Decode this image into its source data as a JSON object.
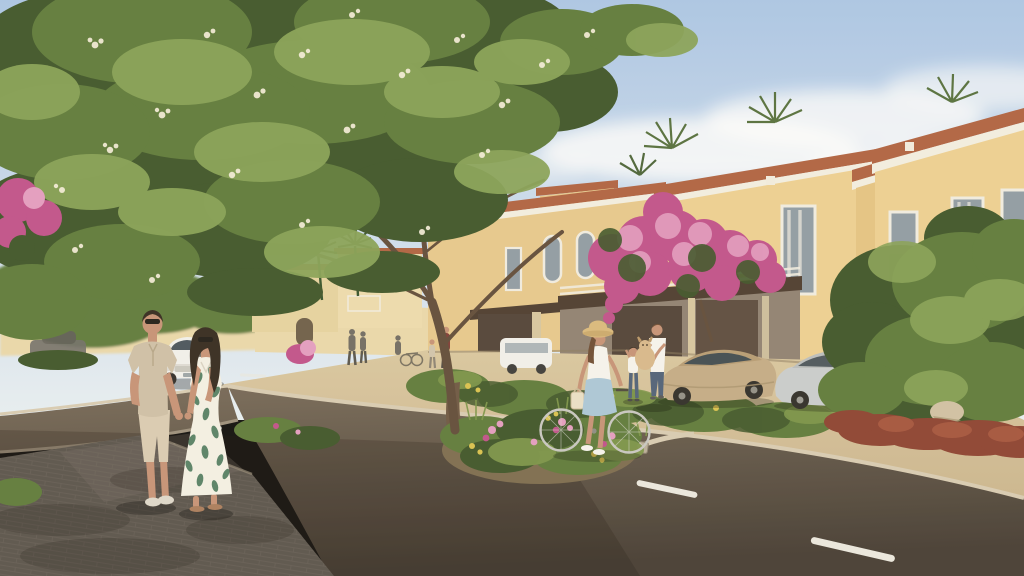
{
  "scene": {
    "type": "architectural-rendering",
    "title": "Residential community street scene",
    "description": "Sunlit rendering of a Mediterranean-style townhouse street: a couple strolls hand-in-hand on a paver sidewalk under a large flowering tree, a woman in a straw hat walks a bicycle across the road, a man carrying a fluffy dog stands with a child by the garages, with parked cars, bougainvillea and lush landscaping",
    "time_of_day": "late afternoon",
    "lighting": "warm sunlight from the right, long soft shadows"
  },
  "palette": {
    "sky_top": "#a9c5e7",
    "sky_horizon": "#e7eff5",
    "cloud": "#ffffff",
    "wall_sunlit": "#eccf92",
    "wall_mid": "#e6c88c",
    "wall_far": "#e9d8ab",
    "cornice": "#f2eee2",
    "roof_tile": "#ae6040",
    "window_glass": "#8d9aa4",
    "window_frame": "#edebe1",
    "garage_door": "#4e4036",
    "garage_fascia": "#4a3a2e",
    "garage_wall": "#82939c",
    "road_near": "#423a32",
    "road_far": "#756858",
    "lane_marking": "#eae8e0",
    "curb": "#d7cbb3",
    "stone": "#b8ad99",
    "sidewalk_sand": "#c9b48e",
    "paver": "#57514b",
    "foliage_dark": "#3c5328",
    "foliage_mid": "#5c793a",
    "foliage_light": "#85a055",
    "blossom": "#f4eedb",
    "trunk": "#6b5642",
    "branch": "#5e4a38",
    "flower_magenta": "#bf4f8a",
    "flower_pink": "#e29bc1",
    "flower_yellow": "#d8c14d",
    "shrub_red": "#8a4030",
    "grass_green": "#7a9448",
    "skin": "#c49176",
    "hair_dark": "#31271e",
    "hair_brown": "#6b4a32",
    "polo_beige": "#cdbfa7",
    "shorts_beige": "#d9cbb3",
    "dress_white": "#f3f0e6",
    "dress_leaf": "#3f7055",
    "denim": "#4d5f78",
    "shirt_white": "#f5f4ef",
    "straw_hat": "#d9b87c",
    "skirt_blue": "#a9c6d9",
    "dog_tan": "#d7b78b",
    "car_white": "#f0f0ed",
    "car_silver": "#c8ccce",
    "car_tan": "#c2aa86",
    "car_dark": "#6e6d69",
    "figure_silhouette": "#6e6a62",
    "figure_maroon": "#7c3b35"
  },
  "people": [
    {
      "label": "man strolling",
      "description": "man in beige polo shirt, beige shorts and sunglasses, left hand in pocket, holding hands with the woman"
    },
    {
      "label": "woman strolling",
      "description": "woman with long dark hair and sunglasses in a white maxi dress with green leaf print"
    },
    {
      "label": "woman with bicycle",
      "description": "woman in a straw sun hat, white top and light-blue skirt walking a bicycle with a hanging bag across the street"
    },
    {
      "label": "man with dog",
      "description": "man in white t-shirt and jeans carrying a fluffy tan dog by the garage"
    },
    {
      "label": "child",
      "description": "small child reaching up toward the dog"
    },
    {
      "label": "distant pedestrians",
      "description": "small groups of residents strolling along the far sidewalk"
    }
  ],
  "vehicles": [
    {
      "label": "white sedan",
      "description": "white sedan parked on the left side of the street in the distance"
    },
    {
      "label": "tan sports coupe",
      "description": "low tan coupe parked by the garage driveways"
    },
    {
      "label": "silver sedan",
      "description": "silver sedan parked further right, partly hidden by a tree"
    },
    {
      "label": "white van",
      "description": "small white vehicle parked near the distant houses"
    },
    {
      "label": "dark car",
      "description": "dark car barely visible behind shrubs at far left"
    }
  ],
  "architecture": {
    "townhouses": "two-storey sand-yellow stucco townhouses with white cornices, terracotta tile roof trim, tall grey-glazed windows and dark brown garage doors with white pergola beams",
    "distant_villas": "cream villas with arched openings, balconies and palm trees along the street"
  },
  "landscape": {
    "big_tree": "large flowering tree with white blossoms overhanging the sidewalk",
    "bougainvillea": "magenta bougainvillea draped over garages and walls",
    "flower_bed": "median bed of pink and yellow flowers with grasses",
    "red_shrubs": "maroon shrub bed under the right foreground tree",
    "palms": "palm crowns rising behind the rooflines"
  }
}
